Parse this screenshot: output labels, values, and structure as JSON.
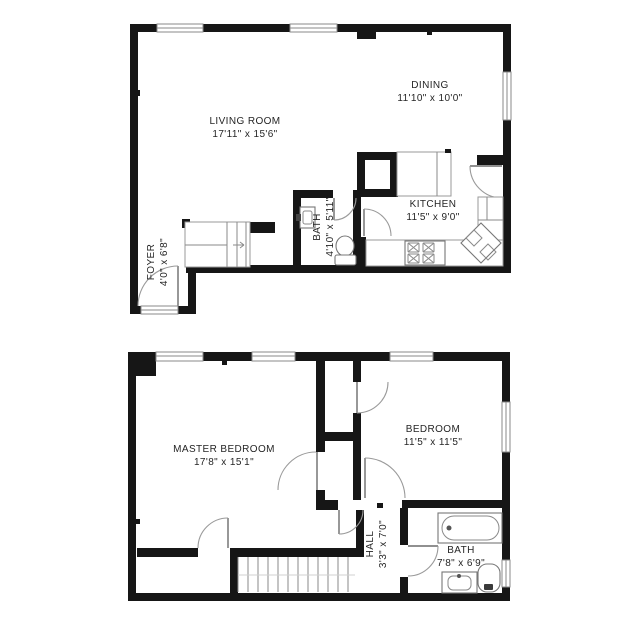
{
  "title": "Two-level apartment floor plan",
  "colors": {
    "wall": "#161616",
    "fixture_line": "#777777",
    "door_line": "#9a9a9a",
    "text": "#252525",
    "background": "#ffffff"
  },
  "upper_floor": {
    "rooms": [
      {
        "id": "living-room",
        "name": "LIVING ROOM",
        "dims": "17'11\" x 15'6\""
      },
      {
        "id": "dining",
        "name": "DINING",
        "dims": "11'10\" x 10'0\""
      },
      {
        "id": "kitchen",
        "name": "KITCHEN",
        "dims": "11'5\" x 9'0\""
      },
      {
        "id": "bath",
        "name": "BATH",
        "dims": "4'10\" x 5'11\""
      },
      {
        "id": "foyer",
        "name": "FOYER",
        "dims": "4'0\" x 6'8\""
      }
    ],
    "fixtures": [
      "stairs-down",
      "bath-sink",
      "toilet",
      "stove",
      "kitchen-corner-sink",
      "refrigerator-counter"
    ]
  },
  "lower_floor": {
    "rooms": [
      {
        "id": "master-bedroom",
        "name": "MASTER BEDROOM",
        "dims": "17'8\" x 15'1\""
      },
      {
        "id": "bedroom",
        "name": "BEDROOM",
        "dims": "11'5\" x 11'5\""
      },
      {
        "id": "hall",
        "name": "HALL",
        "dims": "3'3\" x 7'0\""
      },
      {
        "id": "bath",
        "name": "BATH",
        "dims": "7'8\" x 6'9\""
      }
    ],
    "fixtures": [
      "stairs",
      "bathtub",
      "toilet",
      "vanity-sink",
      "closets"
    ]
  }
}
